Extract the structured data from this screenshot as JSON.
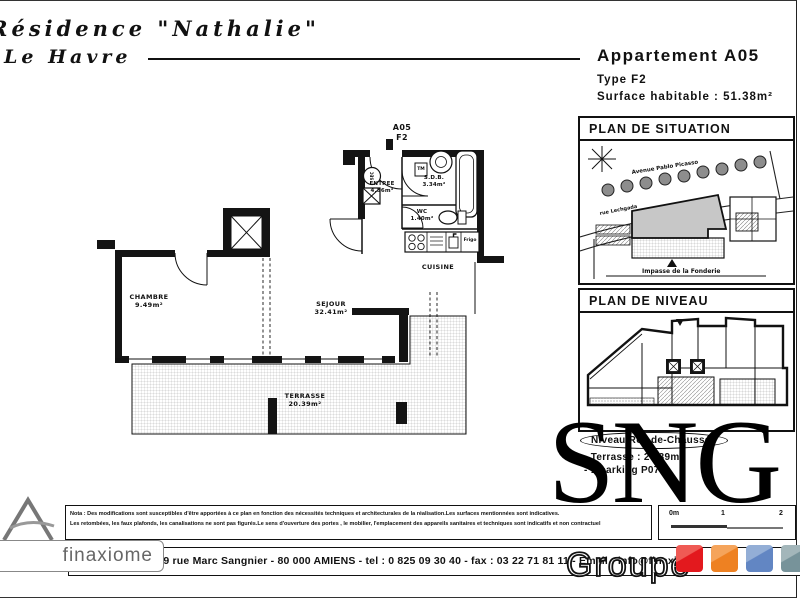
{
  "page": {
    "residence": "Résidence \"Nathalie\"",
    "city": "Le Havre"
  },
  "header": {
    "title": "Appartement A05",
    "type": "Type F2",
    "surface": "Surface habitable : 51.38m²"
  },
  "plan": {
    "unit": {
      "line1": "A05",
      "line2": "F2"
    },
    "rooms": {
      "chambre": {
        "name": "CHAMBRE",
        "area": "9.49m²"
      },
      "sejour": {
        "name": "SEJOUR",
        "area": "32.41m²"
      },
      "terrasse": {
        "name": "TERRASSE",
        "area": "20.39m²"
      },
      "cuisine": {
        "name": "CUISINE"
      },
      "entree": {
        "name": "ENTREE",
        "area": "4.56m²"
      },
      "sdb": {
        "name": "S.D.B.",
        "area": "3.34m²"
      },
      "wc": {
        "name": "WC",
        "area": "1.40m²"
      }
    },
    "fixtures": {
      "fridge": "Frigo",
      "washer": "TM",
      "shaft": "SEC"
    }
  },
  "situation": {
    "title": "PLAN DE SITUATION",
    "street_avenue": "Avenue Pablo Picasso",
    "street_rue": "rue Lechgada",
    "street_impasse": "Impasse de la Fonderie"
  },
  "niveau": {
    "title": "PLAN DE NIVEAU"
  },
  "level_info": {
    "niveau": "Niveau Rez-de-Chaussée",
    "terrasse": "- Terrasse : 20.39m²",
    "parking": "- 1 parking P07"
  },
  "brand": {
    "sng": "SNG",
    "groupe": "Groupe",
    "colors": {
      "red": "#e3191e",
      "orange": "#ee8122",
      "blue": "#6286c3",
      "teal": "#77939a"
    }
  },
  "note": {
    "line1": "Nota : Des modifications sont susceptibles d'être apportées à ce plan en fonction des nécessités techniques et architecturales de la réalisation.Les surfaces mentionnées sont indicatives.",
    "line2": "Les retombées, les faux plafonds, les canalisations ne sont pas figurés.Le sens d'ouverture des portes , le mobilier, l'emplacement des appareils sanitaires et techniques sont indicatifs et non contractuel"
  },
  "scale": {
    "zero": "0m",
    "one": "1",
    "two": "2"
  },
  "footer": {
    "text": "FINAXIOME, 9 rue Marc Sangnier - 80 000 AMIENS  -  tel : 0 825 09 30 40  -  fax : 03 22 71 81 11  -  Email : info@finaxiome"
  },
  "logo": {
    "text": "finaxiome"
  }
}
